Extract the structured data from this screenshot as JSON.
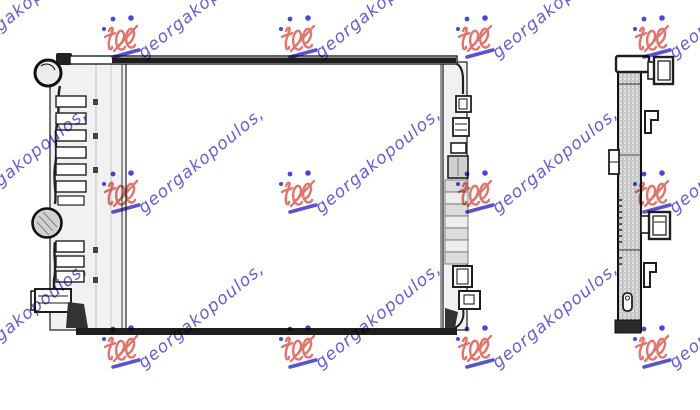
{
  "figure": {
    "description": "Technical line drawing of a car radiator: front view on the left and side profile view on the right, on a white background with a repeating seller watermark.",
    "views": [
      "front view",
      "side profile view"
    ]
  },
  "watermark": {
    "text": "georgakopoulos,",
    "colors": {
      "text": "#5a52cf",
      "logo": "#e0756d",
      "dots": "#4a46d6",
      "underline": "#5a52cf"
    }
  },
  "drawing": {
    "colors": {
      "line": "#1f1f1f",
      "fill": "#f1f1f1",
      "shade": "#d2d2d2",
      "bar": "#1e1e1e"
    }
  }
}
